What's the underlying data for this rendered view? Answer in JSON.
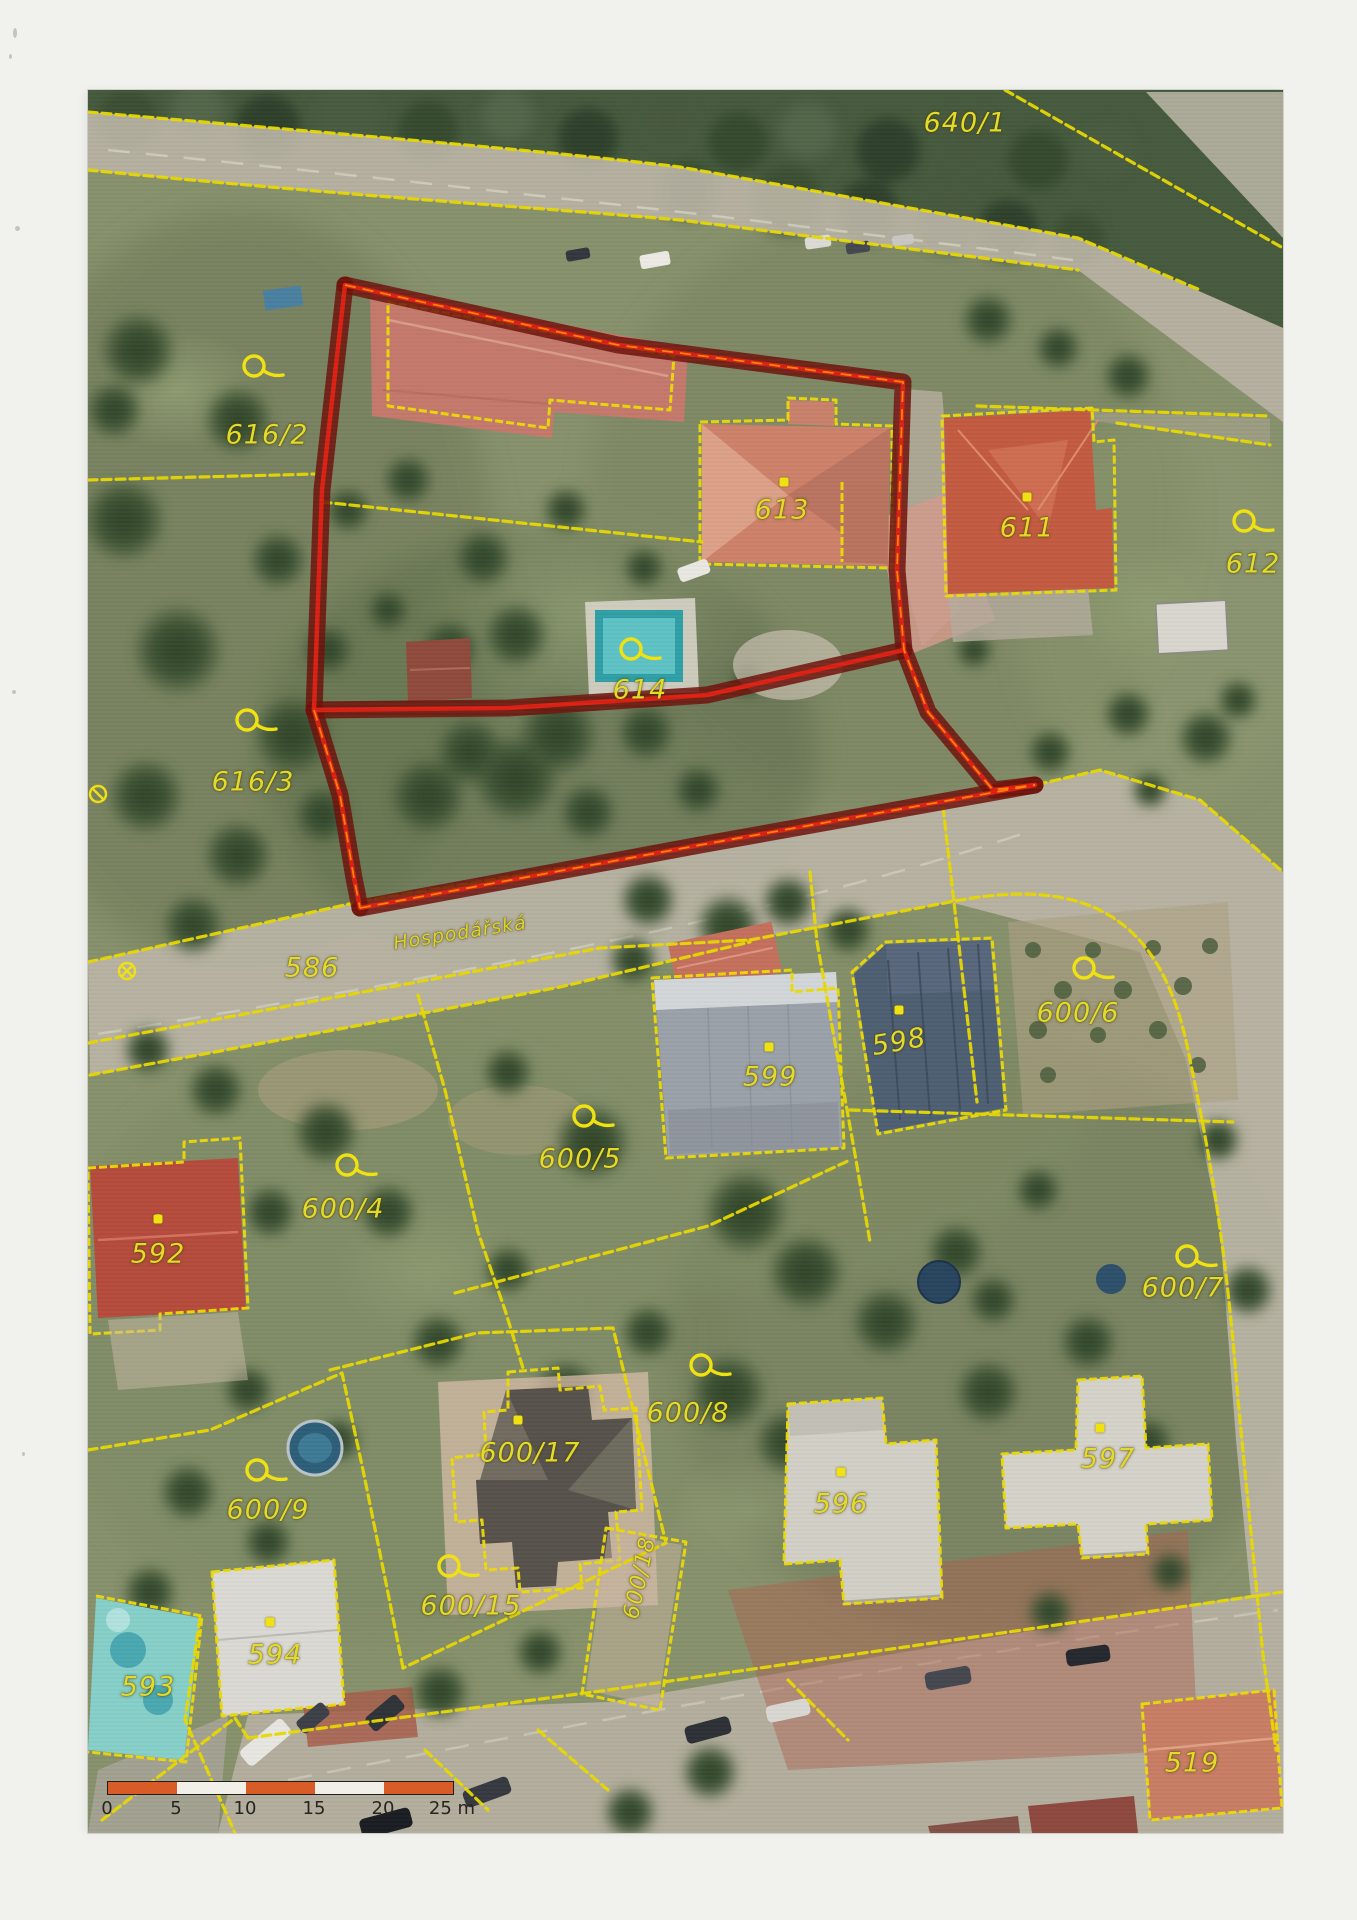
{
  "page": {
    "width": 1357,
    "height": 1920,
    "background": "#f1f2ee",
    "kind": "scanned cadastral orthophoto map sheet"
  },
  "map": {
    "x": 88,
    "y": 90,
    "width": 1195,
    "height": 1743,
    "street_label": {
      "text": "Hospodářská",
      "x": 460,
      "y": 933,
      "rotation": -9
    }
  },
  "parcels": [
    {
      "label": "640/1",
      "x": 965,
      "y": 123,
      "marker": "none"
    },
    {
      "label": "616/2",
      "x": 267,
      "y": 435,
      "marker": "loop",
      "marker_x": 263,
      "marker_y": 370
    },
    {
      "label": "616/3",
      "x": 253,
      "y": 782,
      "marker": "loop",
      "marker_x": 256,
      "marker_y": 724
    },
    {
      "label": "613",
      "x": 782,
      "y": 510,
      "marker": "dot",
      "marker_x": 784,
      "marker_y": 482
    },
    {
      "label": "614",
      "x": 640,
      "y": 690,
      "marker": "loop",
      "marker_x": 640,
      "marker_y": 653
    },
    {
      "label": "611",
      "x": 1027,
      "y": 528,
      "marker": "dot",
      "marker_x": 1027,
      "marker_y": 497
    },
    {
      "label": "612",
      "x": 1253,
      "y": 564,
      "marker": "loop",
      "marker_x": 1253,
      "marker_y": 525
    },
    {
      "label": "586",
      "x": 312,
      "y": 968,
      "marker": "none"
    },
    {
      "label": "599",
      "x": 770,
      "y": 1077,
      "marker": "dot",
      "marker_x": 769,
      "marker_y": 1047
    },
    {
      "label": "598",
      "x": 899,
      "y": 1042,
      "marker": "dot",
      "marker_x": 899,
      "marker_y": 1010,
      "rotation": -10
    },
    {
      "label": "600/6",
      "x": 1078,
      "y": 1013,
      "marker": "loop",
      "marker_x": 1093,
      "marker_y": 972
    },
    {
      "label": "600/5",
      "x": 580,
      "y": 1159,
      "marker": "loop",
      "marker_x": 593,
      "marker_y": 1120
    },
    {
      "label": "600/4",
      "x": 343,
      "y": 1209,
      "marker": "loop",
      "marker_x": 356,
      "marker_y": 1169
    },
    {
      "label": "592",
      "x": 158,
      "y": 1254,
      "marker": "dot",
      "marker_x": 158,
      "marker_y": 1219
    },
    {
      "label": "600/7",
      "x": 1183,
      "y": 1288,
      "marker": "loop",
      "marker_x": 1196,
      "marker_y": 1260
    },
    {
      "label": "600/17",
      "x": 530,
      "y": 1453,
      "marker": "dot",
      "marker_x": 518,
      "marker_y": 1420
    },
    {
      "label": "600/8",
      "x": 688,
      "y": 1413,
      "marker": "loop",
      "marker_x": 710,
      "marker_y": 1369
    },
    {
      "label": "600/9",
      "x": 268,
      "y": 1510,
      "marker": "loop",
      "marker_x": 266,
      "marker_y": 1474
    },
    {
      "label": "596",
      "x": 841,
      "y": 1504,
      "marker": "dot",
      "marker_x": 841,
      "marker_y": 1472
    },
    {
      "label": "597",
      "x": 1108,
      "y": 1459,
      "marker": "dot",
      "marker_x": 1100,
      "marker_y": 1428
    },
    {
      "label": "600/15",
      "x": 471,
      "y": 1606,
      "marker": "loop",
      "marker_x": 458,
      "marker_y": 1570
    },
    {
      "label": "600/18",
      "x": 640,
      "y": 1578,
      "marker": "none",
      "rotation": -78,
      "size": 22
    },
    {
      "label": "594",
      "x": 275,
      "y": 1655,
      "marker": "dot",
      "marker_x": 270,
      "marker_y": 1622
    },
    {
      "label": "593",
      "x": 148,
      "y": 1687,
      "marker": "none"
    },
    {
      "label": "519",
      "x": 1192,
      "y": 1763,
      "marker": "none"
    }
  ],
  "scale_bar": {
    "x": 107,
    "y": 1781,
    "width": 345,
    "height": 12,
    "tick_labels": [
      "0",
      "5",
      "10",
      "15",
      "20",
      "25 m"
    ],
    "segment_colors": [
      "#d85c28",
      "#f2efe8",
      "#d85c28",
      "#f2efe8",
      "#d85c28"
    ],
    "text_color": "#26251f"
  },
  "palette": {
    "boundary_yellow": "#e8d800",
    "label_yellow": "#e4da2a",
    "highlight_dark_red": "#6d120b",
    "highlight_red": "#df2113",
    "highlight_orange": "#ff8d05",
    "road_gray": "#b9b4a4",
    "forest_green": "#465a3e"
  }
}
